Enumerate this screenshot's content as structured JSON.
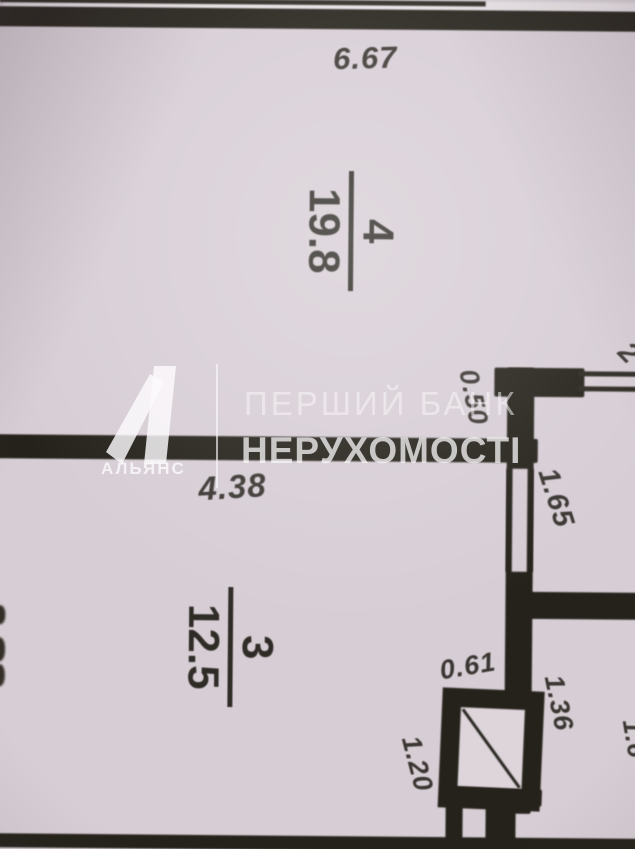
{
  "watermark": {
    "brand": "АЛЬЯНС",
    "title_line1": "ПЕРШИЙ БАНК",
    "title_line2": "НЕРУХОМОСТІ"
  },
  "rooms": {
    "room4": {
      "number": "4",
      "area": "19.8"
    },
    "room3": {
      "number": "3",
      "area": "12.5"
    }
  },
  "dimensions": {
    "top_width": "6.67",
    "room3_width": "4.38",
    "wall_stub": "0.50",
    "upper_niche_depth": "1.65",
    "top_right_partial": "2",
    "duct_width": "0.61",
    "lower_niche_width": "1.36",
    "duct_height": "1.20",
    "right_edge_partial": "1.6"
  },
  "colors": {
    "paper": "#d7ced5",
    "ink": "#25221b",
    "dimension_text": "#3a3632",
    "watermark_white": "#faf8fa"
  }
}
